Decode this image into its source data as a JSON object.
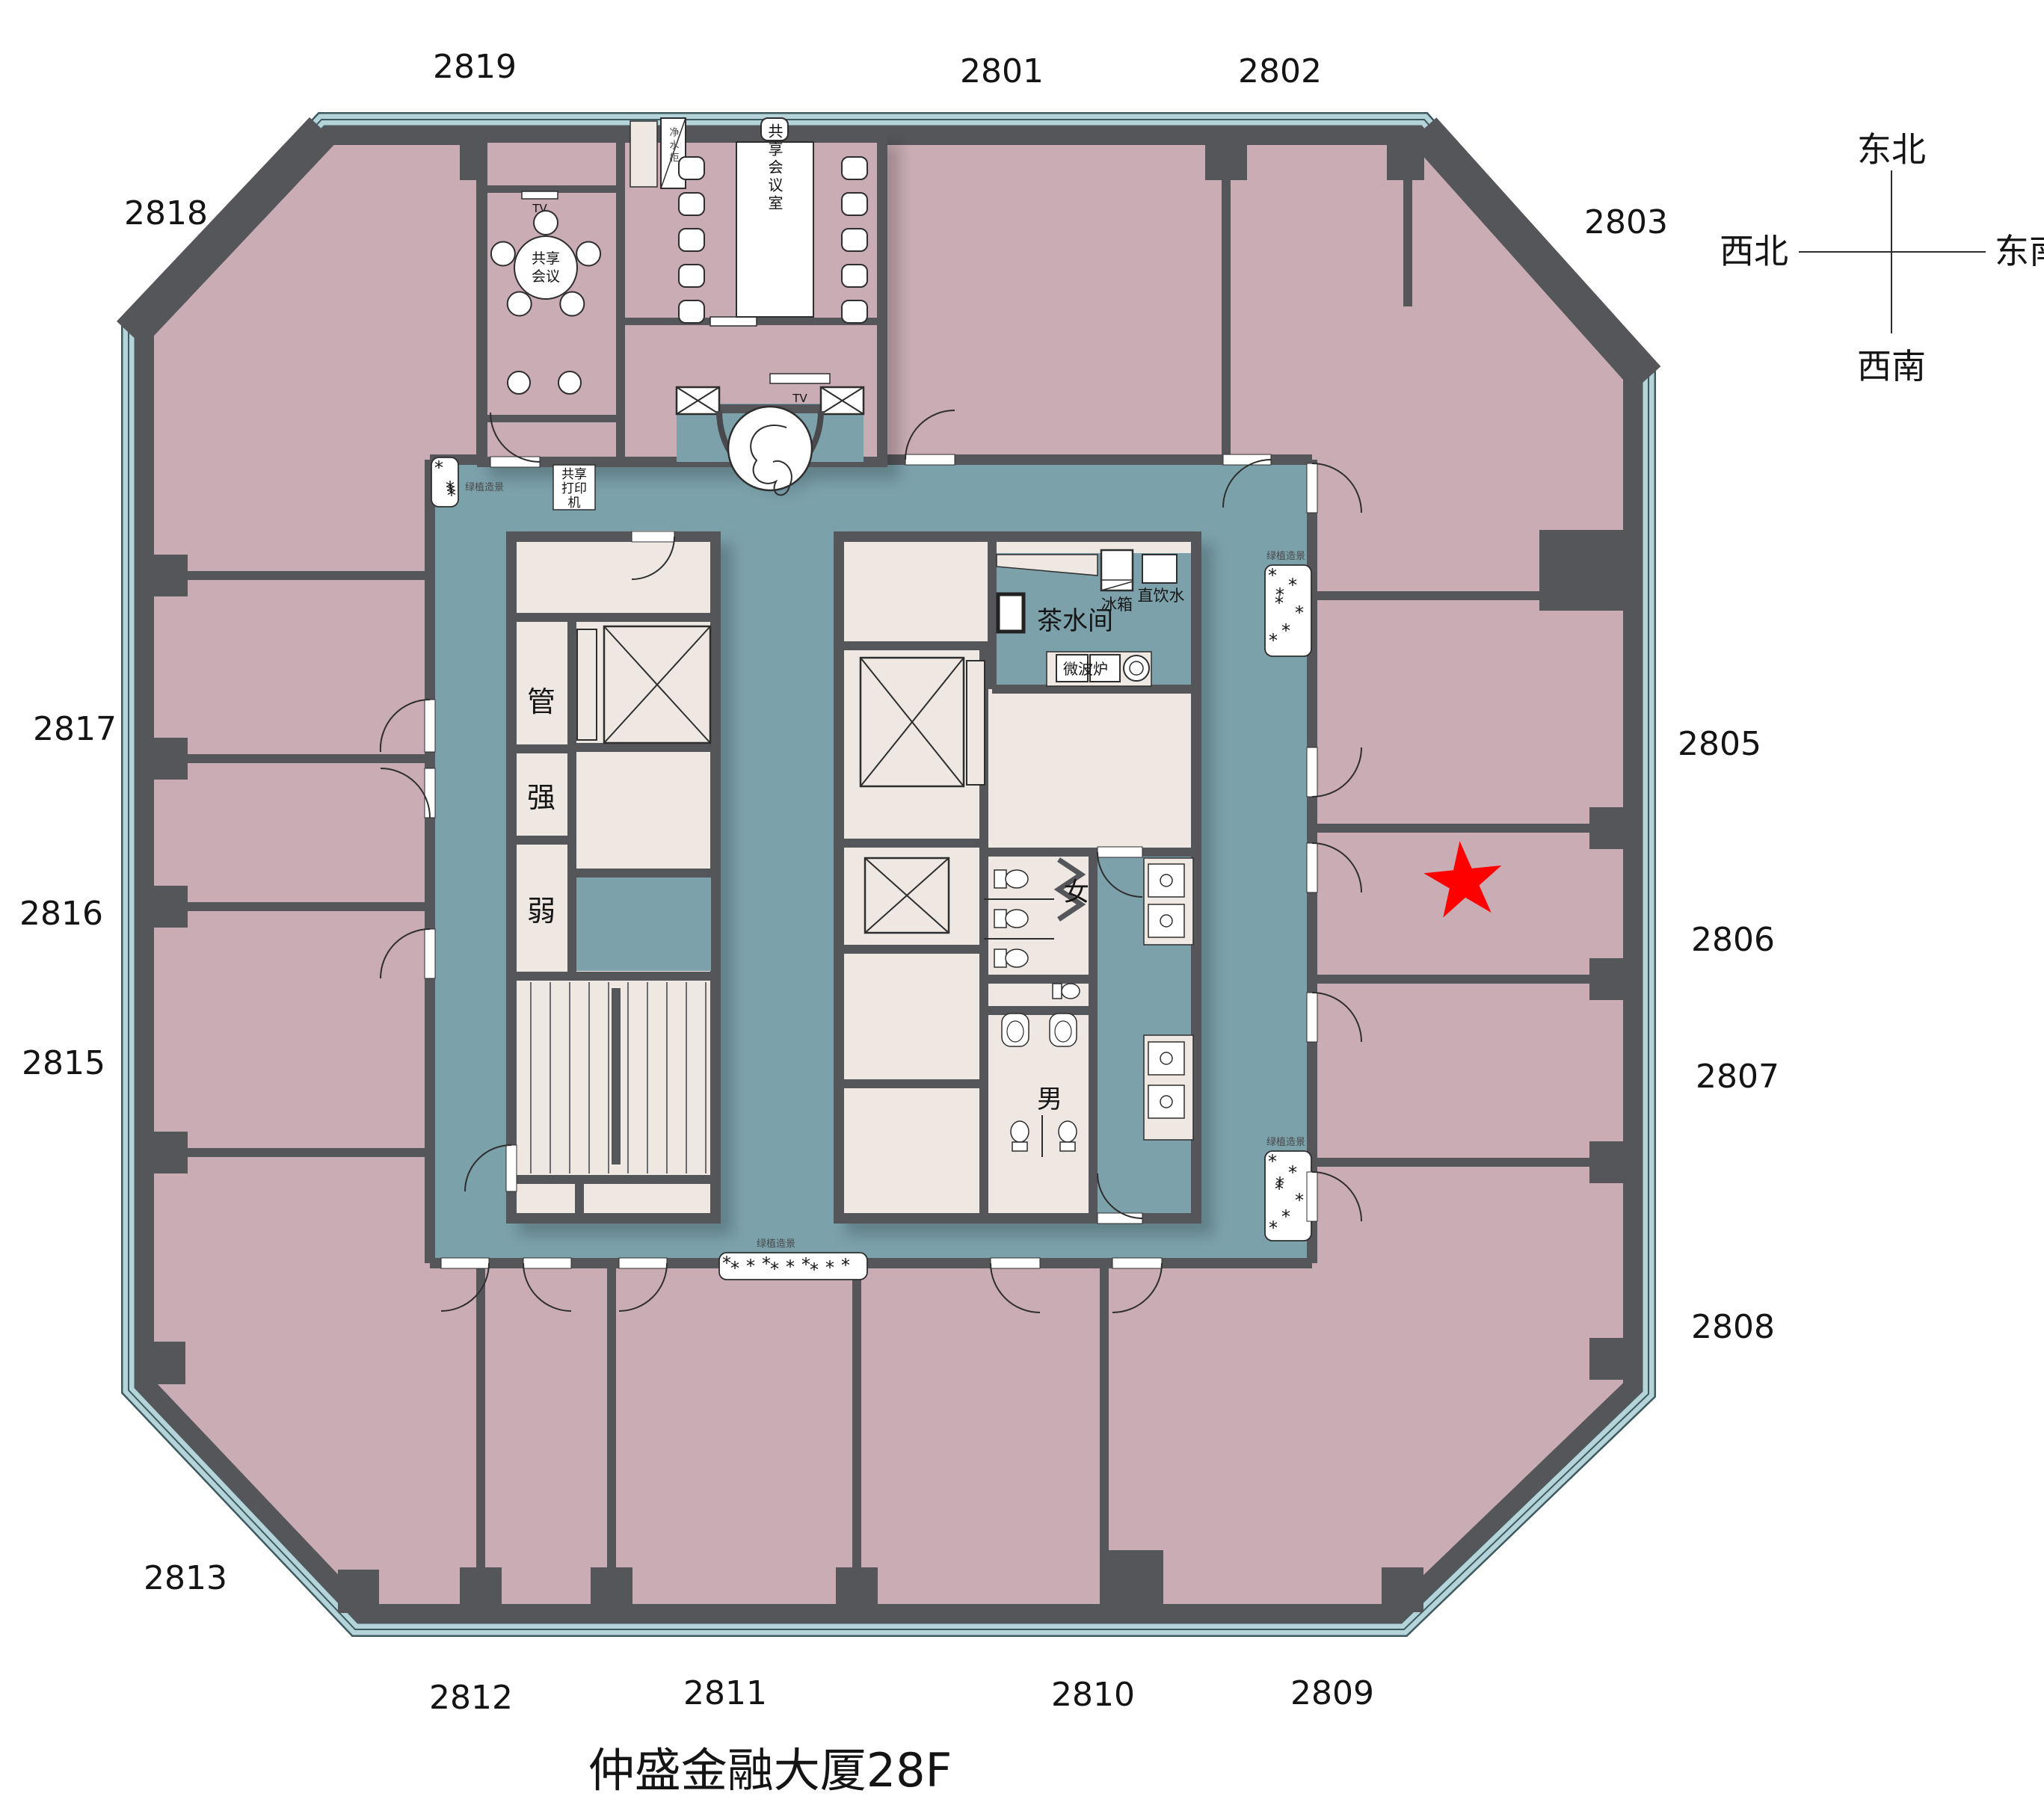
{
  "title": "仲盛金融大厦28F",
  "compass": {
    "ne": "东北",
    "nw": "西北",
    "se": "东南",
    "sw": "西南"
  },
  "rooms": [
    {
      "number": "2819"
    },
    {
      "number": "2801"
    },
    {
      "number": "2802"
    },
    {
      "number": "2818"
    },
    {
      "number": "2803"
    },
    {
      "number": "2817"
    },
    {
      "number": "2805"
    },
    {
      "number": "2816"
    },
    {
      "number": "2806"
    },
    {
      "number": "2815"
    },
    {
      "number": "2807"
    },
    {
      "number": "2808"
    },
    {
      "number": "2813"
    },
    {
      "number": "2812"
    },
    {
      "number": "2811"
    },
    {
      "number": "2810"
    },
    {
      "number": "2809"
    }
  ],
  "labels": {
    "pantry": "茶水间",
    "fridge": "冰箱",
    "direct_water": "直饮水",
    "microwave": "微波炉",
    "women": "女",
    "men": "男",
    "duct": "管",
    "strong": "强",
    "weak": "弱",
    "printer_l1": "共享",
    "printer_l2": "打印",
    "printer_l3": "机",
    "round_meeting_l1": "共享",
    "round_meeting_l2": "会议",
    "meeting_room": "共享会议室",
    "water_cabinet": "净水柜",
    "tv": "TV",
    "planter": "绿植造景"
  },
  "colors": {
    "office": "#C9ACB4",
    "corridor": "#7BA1AB",
    "wall": "#55565A",
    "core_room": "#EFE8E2",
    "window_band": "#B5D4DA",
    "star": "#FF0000"
  }
}
